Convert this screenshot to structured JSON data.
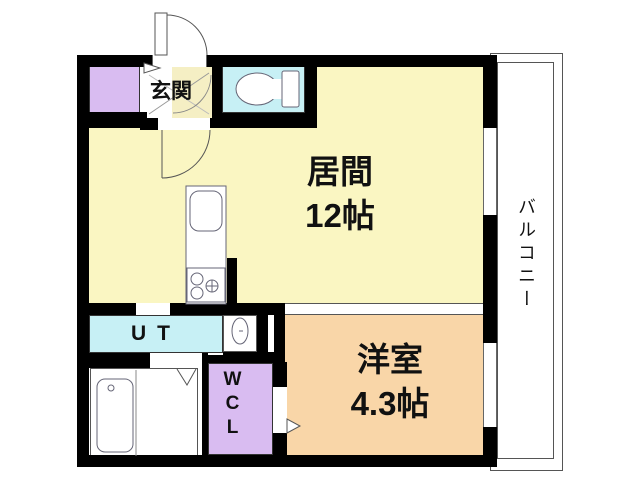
{
  "plan": {
    "title": "1LDK floor plan",
    "rooms": {
      "entrance": {
        "label": "玄関"
      },
      "living": {
        "label": "居間",
        "size": "12帖"
      },
      "western": {
        "label": "洋室",
        "size": "4.3帖"
      },
      "utility": {
        "label": "UT"
      },
      "wcl": {
        "label": "WCL"
      },
      "balcony": {
        "label": "バルコニー"
      }
    },
    "colors": {
      "wall": "#000000",
      "living_fill": "#faf6c2",
      "western_fill": "#f9d6a8",
      "wet_area_fill": "#c7f0f5",
      "storage_fill": "#d9bcf1",
      "entrance_fill": "#f5efc4",
      "outline": "#555555"
    },
    "icons": [
      "toilet-icon",
      "kitchen-sink-icon",
      "gas-stove-icon",
      "bathtub-icon",
      "washbasin-icon",
      "door-swing-icon",
      "entrance-door-swing-icon",
      "folding-door-icon",
      "entrance-step-arrow-icon",
      "wcl-door-arrow-icon"
    ]
  }
}
